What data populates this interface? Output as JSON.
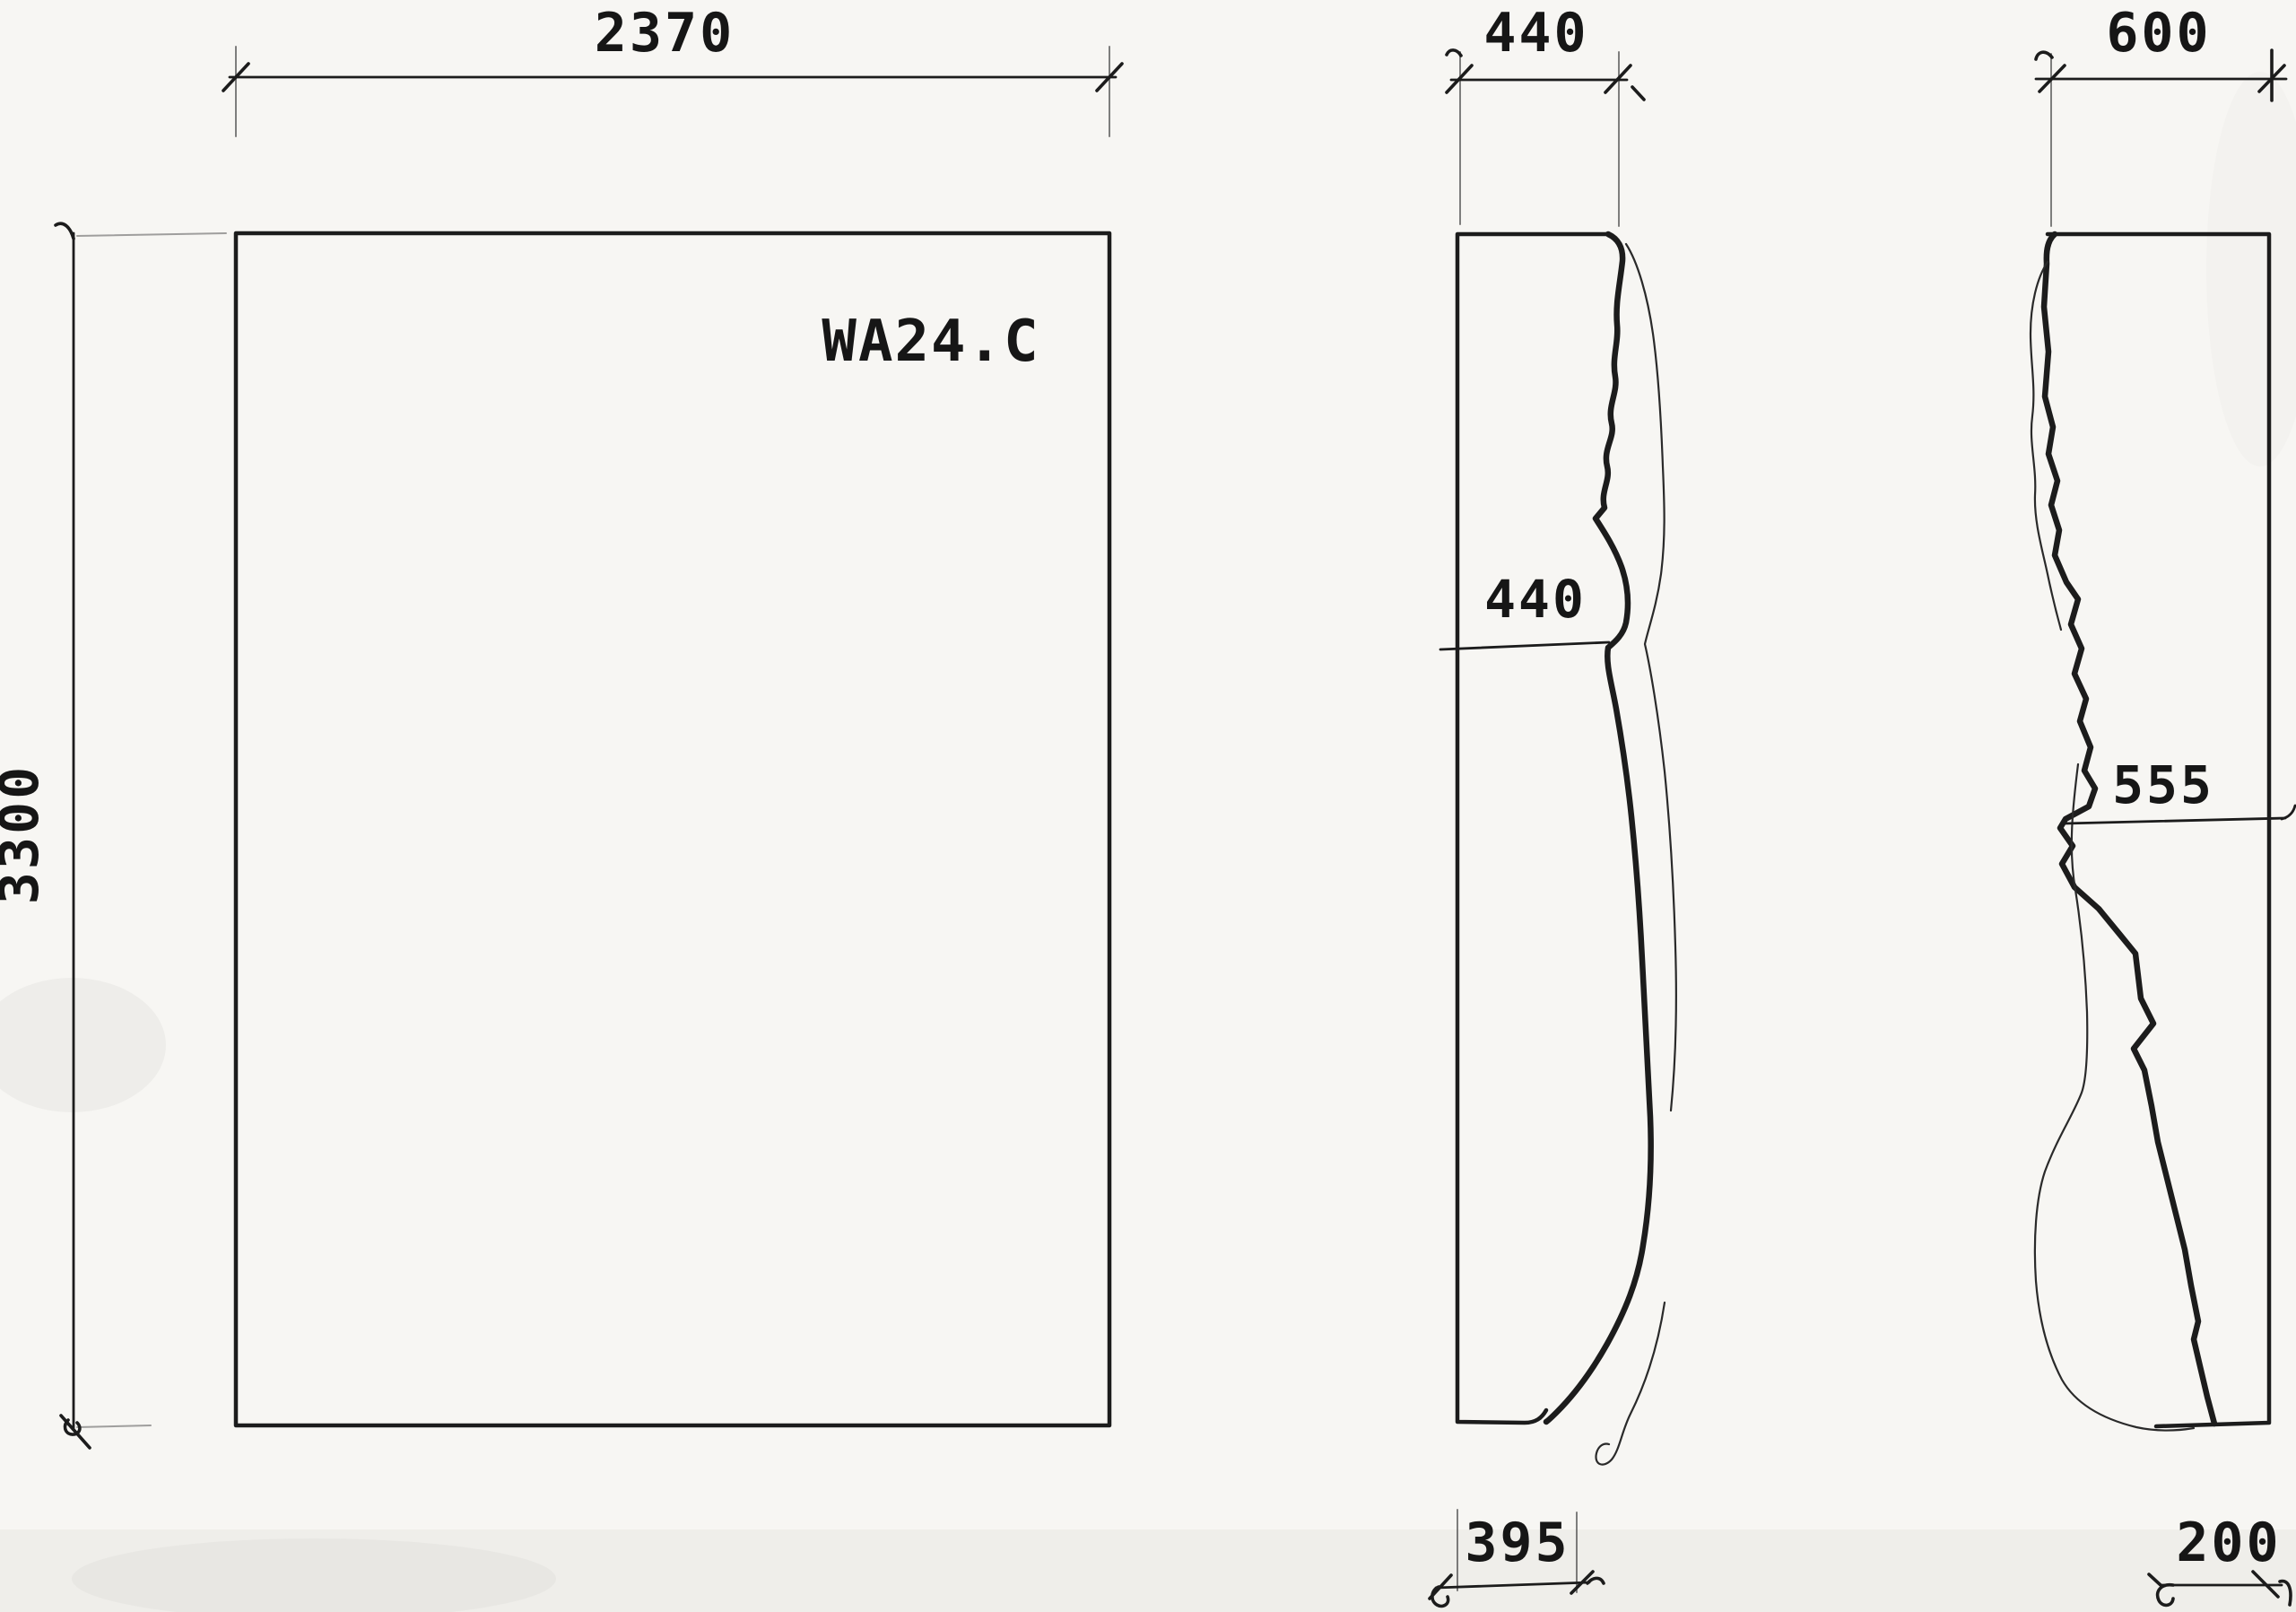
{
  "drawing": {
    "part_label": "WA24.C",
    "front_view": {
      "width_dim": "2370",
      "height_dim": "3300"
    },
    "middle_profile": {
      "top_dim": "440",
      "inner_dim": "440",
      "bottom_dim": "395"
    },
    "right_profile": {
      "top_dim": "600",
      "inner_dim": "555",
      "bottom_dim": "200"
    }
  },
  "colors": {
    "paper": "#f7f6f3",
    "ink": "#1c1c1c"
  }
}
